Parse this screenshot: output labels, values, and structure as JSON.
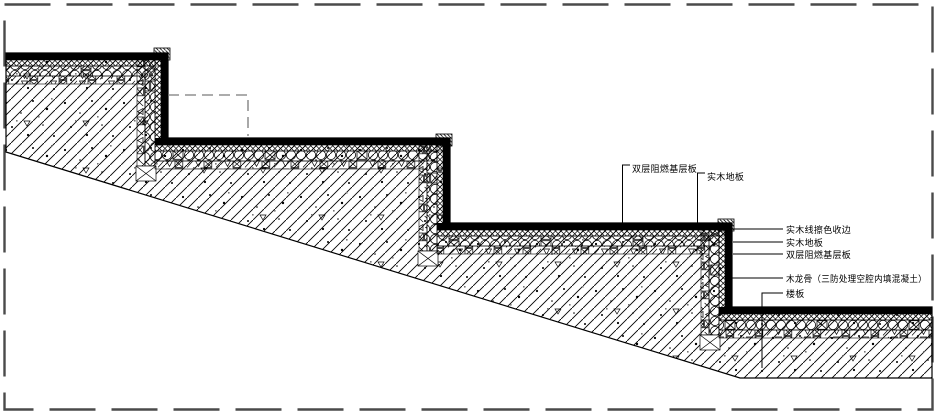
{
  "drawing": {
    "type": "stair-construction-detail-section",
    "steps_visible": 3
  },
  "annotations": {
    "top": [
      {
        "text": "双层阻燃基层板"
      },
      {
        "text": "实木地板"
      }
    ],
    "right": [
      {
        "text": "实木线擦色收边"
      },
      {
        "text": "实木地板"
      },
      {
        "text": "双层阻燃基层板"
      },
      {
        "text": "木龙骨（三防处理空腔内填混凝土）"
      },
      {
        "text": "楼板"
      }
    ]
  },
  "colors": {
    "ink": "#000000",
    "frame_dash": "#4a4a4a",
    "callout_dash": "#7a7a7a",
    "background": "#ffffff"
  },
  "icons": {
    "concrete-hatch-icon": "diagonal lines with aggregate specks",
    "crosshatch-icon": "diamond lattice board layer",
    "keel-circles-icon": "row of circles (wood keel)",
    "blocking-icon": "squares with X and nabla marks"
  }
}
